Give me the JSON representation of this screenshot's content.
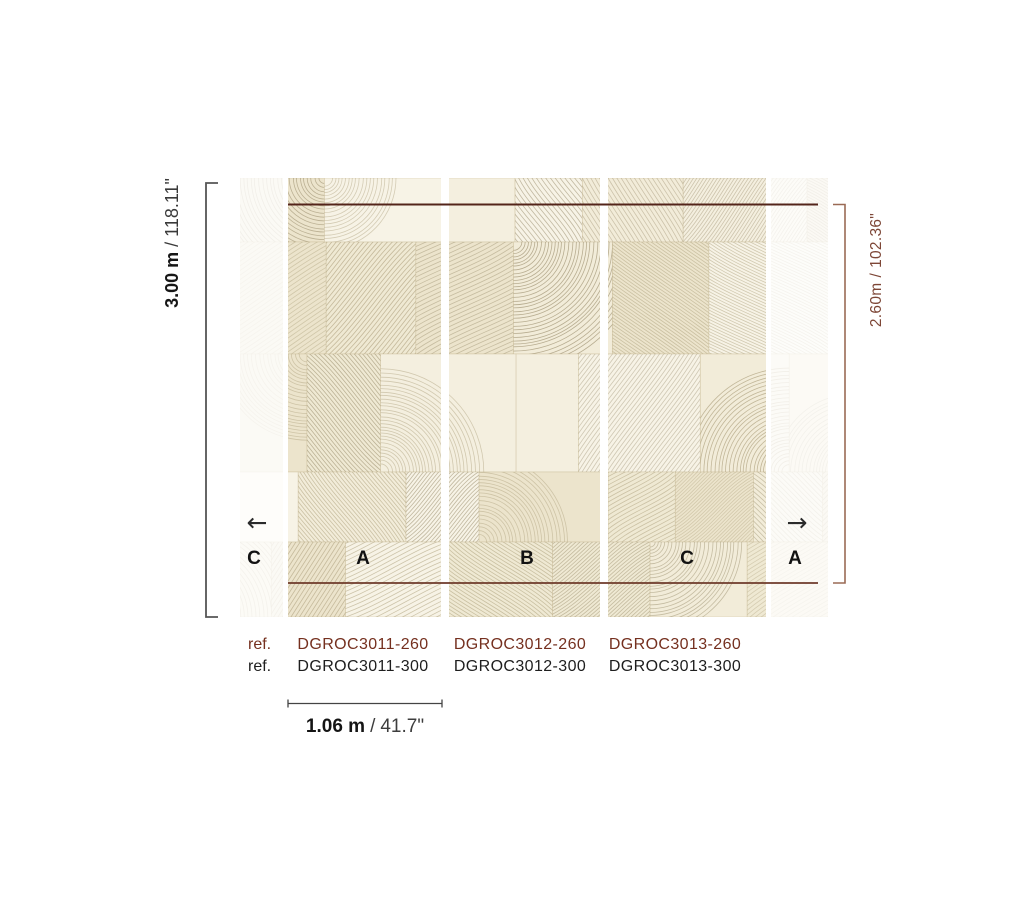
{
  "colors": {
    "background": "#ffffff",
    "dimension_red": "#53241a",
    "bracket_red": "#9a6a55",
    "ref_red": "#75301f",
    "text_dark": "#1c1c1c",
    "bracket_gray": "#555555",
    "mural_base": "#f2ecd9",
    "mural_stroke": "#a89a76"
  },
  "dimensions": {
    "height_total": {
      "metric": "3.00 m",
      "separator": "/",
      "imperial": "118.11\""
    },
    "height_trimmed": {
      "metric": "2.60m",
      "separator": "/",
      "imperial": "102.36\""
    },
    "panel_width": {
      "metric": "1.06 m",
      "separator": "/",
      "imperial": "41.7\""
    }
  },
  "panels": {
    "labels": [
      "C",
      "A",
      "B",
      "C",
      "A"
    ],
    "arrow_left": "←",
    "arrow_right": "→"
  },
  "references": {
    "row_260": {
      "label": "ref.",
      "codes": [
        "DGROC3011-260",
        "DGROC3012-260",
        "DGROC3013-260"
      ]
    },
    "row_300": {
      "label": "ref.",
      "codes": [
        "DGROC3011-300",
        "DGROC3012-300",
        "DGROC3013-300"
      ]
    }
  }
}
